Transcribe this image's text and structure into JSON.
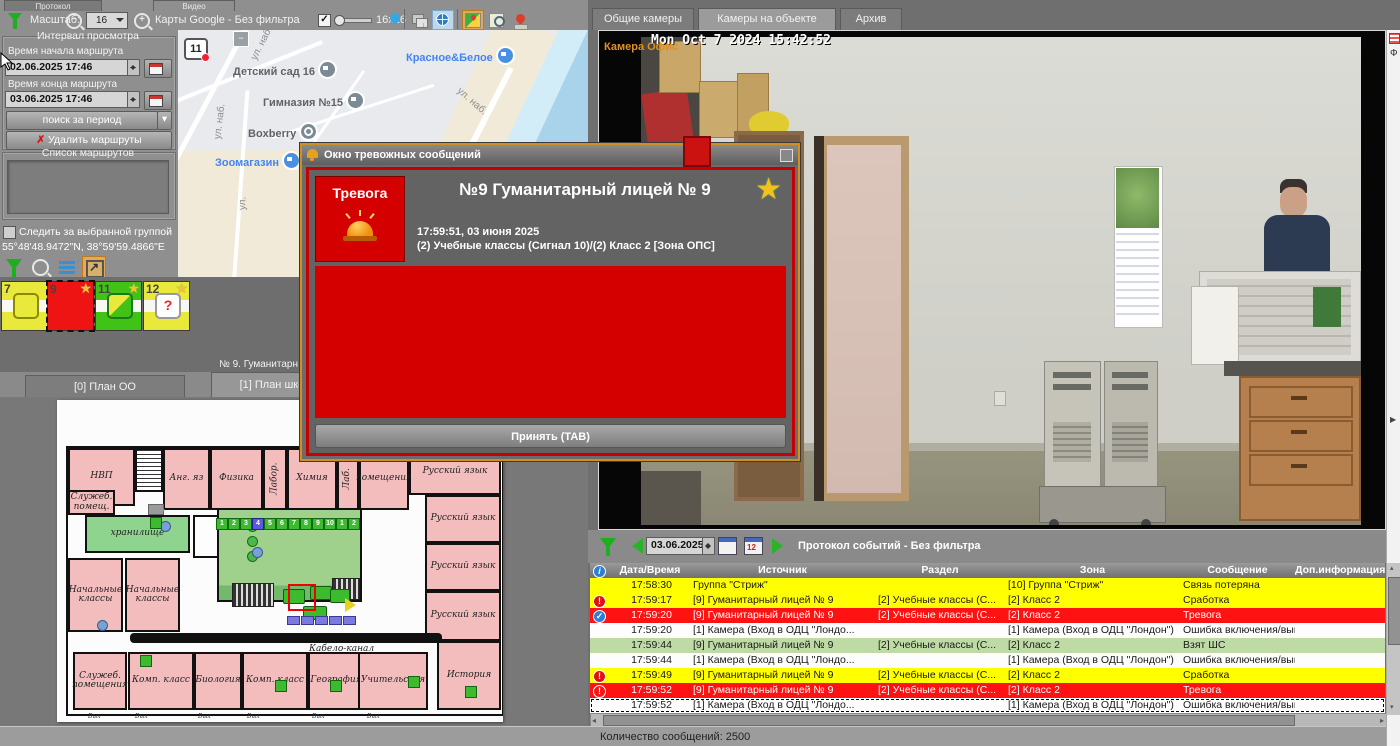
{
  "colors": {
    "alarm_red": "#d40000",
    "accent_gold": "#cf9020",
    "row_yellow": "#ffff00",
    "row_red": "#ff1212",
    "row_green": "#bedba6",
    "tile_yellow": "#e9e93c",
    "tile_green": "#41c217",
    "tile_red": "#ee1414",
    "map_blue": "#4285f4"
  },
  "top_tabs": [
    {
      "label": "Протокол"
    },
    {
      "label": "Видео"
    }
  ],
  "toolbar": {
    "scale_label": "Масштаб:",
    "scale_value": "16",
    "map_source": "Карты Google - Без фильтра",
    "icon_size_label": "16x16"
  },
  "route_panel": {
    "group_title": "Интервал просмотра",
    "start_label": "Время начала маршрута",
    "start_value": "02.06.2025 17:46",
    "end_label": "Время конца маршрута",
    "end_value": "03.06.2025 17:46",
    "search_button": "поиск за период",
    "delete_button": "Удалить маршруты",
    "list_title": "Список маршрутов"
  },
  "follow_group_label": "Следить за выбранной группой",
  "coordinates": "55°48'48.9472\"N, 38°59'59.4866\"E",
  "map": {
    "marker_label": "11",
    "pois": [
      {
        "label": "Детский сад 16",
        "x": 55,
        "y": 30,
        "type": "school",
        "color": "#5f6368"
      },
      {
        "label": "Красное&Белое",
        "x": 228,
        "y": 16,
        "type": "lock",
        "color": "#4285f4"
      },
      {
        "label": "Гимназия №15",
        "x": 85,
        "y": 61,
        "type": "school",
        "color": "#5f6368"
      },
      {
        "label": "Boxberry",
        "x": 70,
        "y": 92,
        "type": "dot",
        "color": "#5f6368"
      },
      {
        "label": "Зоомагазин",
        "x": 37,
        "y": 121,
        "type": "bag",
        "color": "#4285f4"
      }
    ],
    "streets": [
      {
        "label": "ул. наб.",
        "x": 66,
        "y": 8,
        "rot": -63
      },
      {
        "label": "ул. наб.",
        "x": 24,
        "y": 86,
        "rot": -83
      },
      {
        "label": "ул. наб.",
        "x": 276,
        "y": 66,
        "rot": 41
      },
      {
        "label": "ул.",
        "x": 58,
        "y": 168,
        "rot": -88
      }
    ]
  },
  "object_tiles": [
    {
      "num": "7",
      "x": 1,
      "color": "yellow",
      "icon": "rounded",
      "star": false,
      "selected": false
    },
    {
      "num": "9",
      "x": 47,
      "color": "red",
      "icon": "none",
      "star": true,
      "selected": true
    },
    {
      "num": "11",
      "x": 95,
      "color": "green",
      "icon": "diag",
      "star": true,
      "selected": false
    },
    {
      "num": "12",
      "x": 143,
      "color": "yellow",
      "icon": "question",
      "star": true,
      "selected": false
    }
  ],
  "object_status": "№ 9. Гуманитарн",
  "plan_tabs": [
    {
      "label": "[0] План ОО",
      "active": false
    },
    {
      "label": "[1] План школы",
      "active": true
    }
  ],
  "floor_plan": {
    "rooms": [
      {
        "label": "НВП",
        "x": 11,
        "y": 48,
        "w": 67,
        "h": 58,
        "cls": "pink"
      },
      {
        "label": "",
        "x": 78,
        "y": 48,
        "w": 28,
        "h": 44,
        "cls": "hatch"
      },
      {
        "label": "Анг. яз",
        "x": 106,
        "y": 48,
        "w": 47,
        "h": 62,
        "cls": "pink"
      },
      {
        "label": "Физика",
        "x": 153,
        "y": 48,
        "w": 53,
        "h": 62,
        "cls": "pink"
      },
      {
        "label": "Лабор.",
        "x": 206,
        "y": 48,
        "w": 24,
        "h": 62,
        "cls": "pink",
        "rot": true
      },
      {
        "label": "Химия",
        "x": 230,
        "y": 48,
        "w": 50,
        "h": 62,
        "cls": "pink"
      },
      {
        "label": "Лаб.",
        "x": 280,
        "y": 48,
        "w": 22,
        "h": 62,
        "cls": "pink",
        "rot": true
      },
      {
        "label": "помещения",
        "x": 302,
        "y": 48,
        "w": 50,
        "h": 62,
        "cls": "pink"
      },
      {
        "label": "Русский язык",
        "x": 352,
        "y": 48,
        "w": 92,
        "h": 47,
        "cls": "pink"
      },
      {
        "label": "Русский язык",
        "x": 368,
        "y": 95,
        "w": 76,
        "h": 48,
        "cls": "pink"
      },
      {
        "label": "Русский язык",
        "x": 368,
        "y": 143,
        "w": 76,
        "h": 48,
        "cls": "pink"
      },
      {
        "label": "Русский язык",
        "x": 368,
        "y": 191,
        "w": 76,
        "h": 50,
        "cls": "pink"
      },
      {
        "label": "История",
        "x": 380,
        "y": 241,
        "w": 64,
        "h": 69,
        "cls": "pink"
      },
      {
        "label": "Служеб. помещ.",
        "x": 11,
        "y": 90,
        "w": 47,
        "h": 25,
        "cls": "pink"
      },
      {
        "label": "хранилище",
        "x": 28,
        "y": 115,
        "w": 105,
        "h": 38,
        "cls": "green"
      },
      {
        "label": "",
        "x": 136,
        "y": 115,
        "w": 59,
        "h": 43,
        "cls": "white"
      },
      {
        "label": "",
        "x": 160,
        "y": 108,
        "w": 145,
        "h": 94,
        "cls": "hall"
      },
      {
        "label": "Начальные классы",
        "x": 11,
        "y": 158,
        "w": 55,
        "h": 74,
        "cls": "pink"
      },
      {
        "label": "Начальные классы",
        "x": 68,
        "y": 158,
        "w": 55,
        "h": 74,
        "cls": "pink"
      },
      {
        "label": "Служеб. помещения",
        "x": 16,
        "y": 252,
        "w": 54,
        "h": 58,
        "cls": "pink"
      },
      {
        "label": "Комп. класс",
        "x": 71,
        "y": 252,
        "w": 66,
        "h": 58,
        "cls": "pink"
      },
      {
        "label": "Биология",
        "x": 137,
        "y": 252,
        "w": 48,
        "h": 58,
        "cls": "pink"
      },
      {
        "label": "Комп. класс",
        "x": 185,
        "y": 252,
        "w": 66,
        "h": 58,
        "cls": "pink"
      },
      {
        "label": "География",
        "x": 251,
        "y": 252,
        "w": 56,
        "h": 58,
        "cls": "pink"
      },
      {
        "label": "Учительская",
        "x": 301,
        "y": 252,
        "w": 70,
        "h": 58,
        "cls": "pink"
      }
    ],
    "cable_label": "Кабело-канал",
    "sensor_row": {
      "x": 159,
      "y": 118,
      "items": [
        "1",
        "2",
        "3",
        "4",
        "5",
        "6",
        "7",
        "8",
        "9",
        "10",
        "1",
        "2"
      ],
      "blue_index": 3
    },
    "room_sensors": [
      {
        "x": 218,
        "y": 280
      },
      {
        "x": 273,
        "y": 280
      },
      {
        "x": 351,
        "y": 276
      },
      {
        "x": 408,
        "y": 286
      },
      {
        "x": 83,
        "y": 255
      },
      {
        "x": 93,
        "y": 117
      }
    ],
    "exit_label": "Вых",
    "exits_x": [
      31,
      78,
      141,
      190,
      255,
      310
    ]
  },
  "alarm_window": {
    "title": "Окно тревожных сообщений",
    "alarm_label": "Тревога",
    "object_title": "№9 Гуманитарный лицей  № 9",
    "time": "17:59:51, 03 июня 2025",
    "zone": "(2) Учебные классы (Сигнал 10)/(2) Класс 2 [Зона ОПС]",
    "accept_button": "Принять (TAB)"
  },
  "camera_panel": {
    "tabs": [
      {
        "label": "Общие камеры",
        "active": false
      },
      {
        "label": "Камеры на объекте",
        "active": true
      },
      {
        "label": "Архив",
        "active": false
      }
    ],
    "camera_name": "Камера Офис",
    "timestamp": "Mon Oct  7 2024 15:42:52"
  },
  "event_log": {
    "date_value": "03.06.2025",
    "title": "Протокол событий - Без фильтра",
    "columns": [
      "Дата/Время",
      "Источник",
      "Раздел",
      "Зона",
      "Сообщение",
      "Доп.информация"
    ],
    "rows": [
      {
        "icon": "",
        "time": "17:58:30",
        "source": "Группа \"Стриж\"",
        "section": "",
        "zone": "[10] Группа \"Стриж\"",
        "message": "Связь потеряна",
        "info": "",
        "color": "yellow",
        "selected": false
      },
      {
        "icon": "alert",
        "time": "17:59:17",
        "source": "[9] Гуманитарный лицей  № 9",
        "section": "[2] Учебные классы (С...",
        "zone": "[2] Класс 2",
        "message": "Сработка",
        "info": "",
        "color": "yellow",
        "selected": false
      },
      {
        "icon": "check",
        "time": "17:59:20",
        "source": "[9] Гуманитарный лицей  № 9",
        "section": "[2] Учебные классы (С...",
        "zone": "[2] Класс 2",
        "message": "Тревога",
        "info": "",
        "color": "red",
        "selected": false
      },
      {
        "icon": "",
        "time": "17:59:20",
        "source": "[1] Камера (Вход в ОДЦ \"Лондо...",
        "section": "",
        "zone": "[1] Камера (Вход в ОДЦ \"Лондон\")",
        "message": "Ошибка включения/выключения за...",
        "info": "",
        "color": "white",
        "selected": false
      },
      {
        "icon": "",
        "time": "17:59:44",
        "source": "[9] Гуманитарный лицей  № 9",
        "section": "[2] Учебные классы (С...",
        "zone": "[2] Класс 2",
        "message": "Взят ШС",
        "info": "",
        "color": "green",
        "selected": false
      },
      {
        "icon": "",
        "time": "17:59:44",
        "source": "[1] Камера (Вход в ОДЦ \"Лондо...",
        "section": "",
        "zone": "[1] Камера (Вход в ОДЦ \"Лондон\")",
        "message": "Ошибка включения/выключения за...",
        "info": "",
        "color": "white",
        "selected": false
      },
      {
        "icon": "alert",
        "time": "17:59:49",
        "source": "[9] Гуманитарный лицей  № 9",
        "section": "[2] Учебные классы (С...",
        "zone": "[2] Класс 2",
        "message": "Сработка",
        "info": "",
        "color": "yellow",
        "selected": false
      },
      {
        "icon": "alert2",
        "time": "17:59:52",
        "source": "[9] Гуманитарный лицей  № 9",
        "section": "[2] Учебные классы (С...",
        "zone": "[2] Класс 2",
        "message": "Тревога",
        "info": "",
        "color": "red",
        "selected": false
      },
      {
        "icon": "",
        "time": "17:59:52",
        "source": "[1] Камера (Вход в ОДЦ \"Лондо...",
        "section": "",
        "zone": "[1] Камера (Вход в ОДЦ \"Лондон\")",
        "message": "Ошибка включения/выключения за...",
        "info": "",
        "color": "white",
        "selected": true
      }
    ],
    "status": "Количество сообщений: 2500"
  },
  "side_strip_letter": "Ф"
}
